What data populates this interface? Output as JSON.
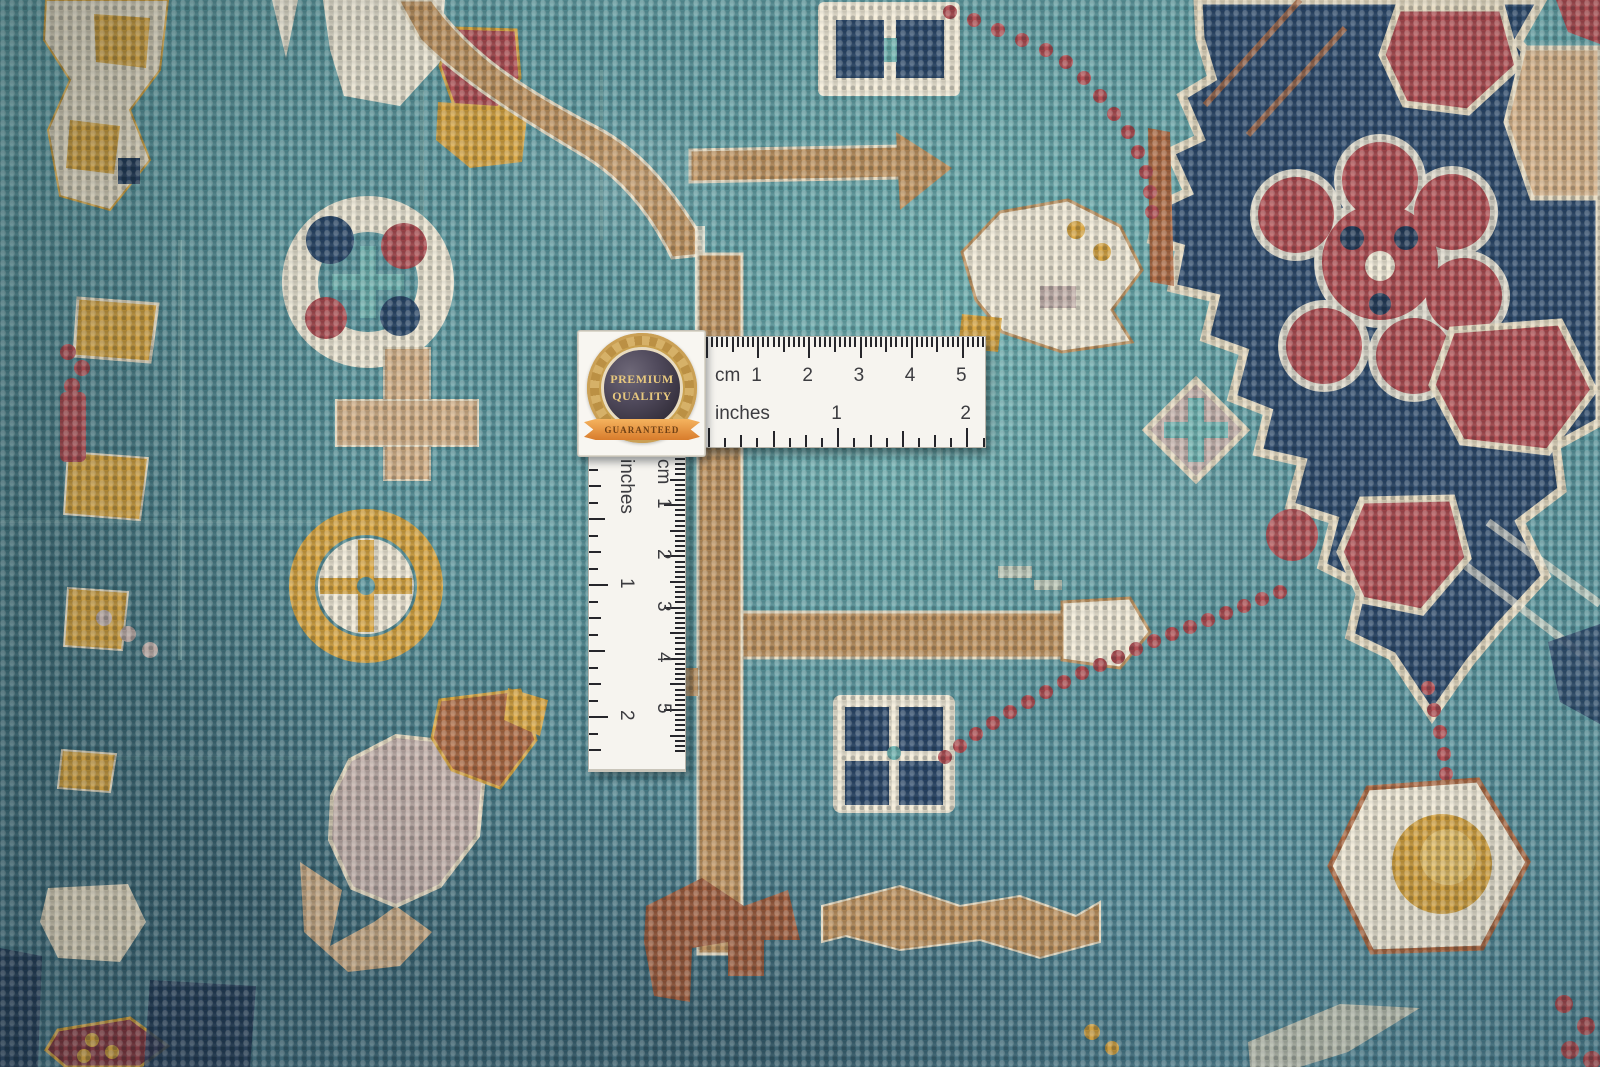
{
  "badge": {
    "premium": "PREMIUM",
    "quality": "QUALITY",
    "guaranteed": "GUARANTEED"
  },
  "horizontal_ruler": {
    "cm_label": "cm",
    "cm_numbers": [
      "1",
      "2",
      "3",
      "4",
      "5"
    ],
    "inch_label": "inches",
    "inch_numbers": [
      "1",
      "2"
    ]
  },
  "vertical_ruler": {
    "cm_label": "cm",
    "cm_numbers": [
      "1",
      "2",
      "3",
      "4",
      "5"
    ],
    "inch_label": "inches",
    "inch_numbers": [
      "1",
      "2"
    ]
  },
  "palette": {
    "teal_base": "#5b98a0",
    "teal_light": "#6fb5b2",
    "teal_pale": "#a7d2cb",
    "navy": "#2b486b",
    "navy_dark": "#233a58",
    "red": "#b14b50",
    "red_dark": "#8f3a42",
    "rust": "#b06a42",
    "rust_dark": "#a05c3c",
    "camel": "#c2945f",
    "camel_light": "#d8b389",
    "gold": "#dba63f",
    "gold_light": "#eac266",
    "cream": "#e8dcc2",
    "cream_bright": "#f4ecd8",
    "lavender": "#c8b4ae",
    "ruler_white": "#f6f4ef",
    "tick_color": "#26262b",
    "ruler_text": "#3c3c40",
    "badge_gold": "#c9a14f",
    "badge_dark": "#3b3542",
    "ribbon_orange": "#e8913f"
  }
}
